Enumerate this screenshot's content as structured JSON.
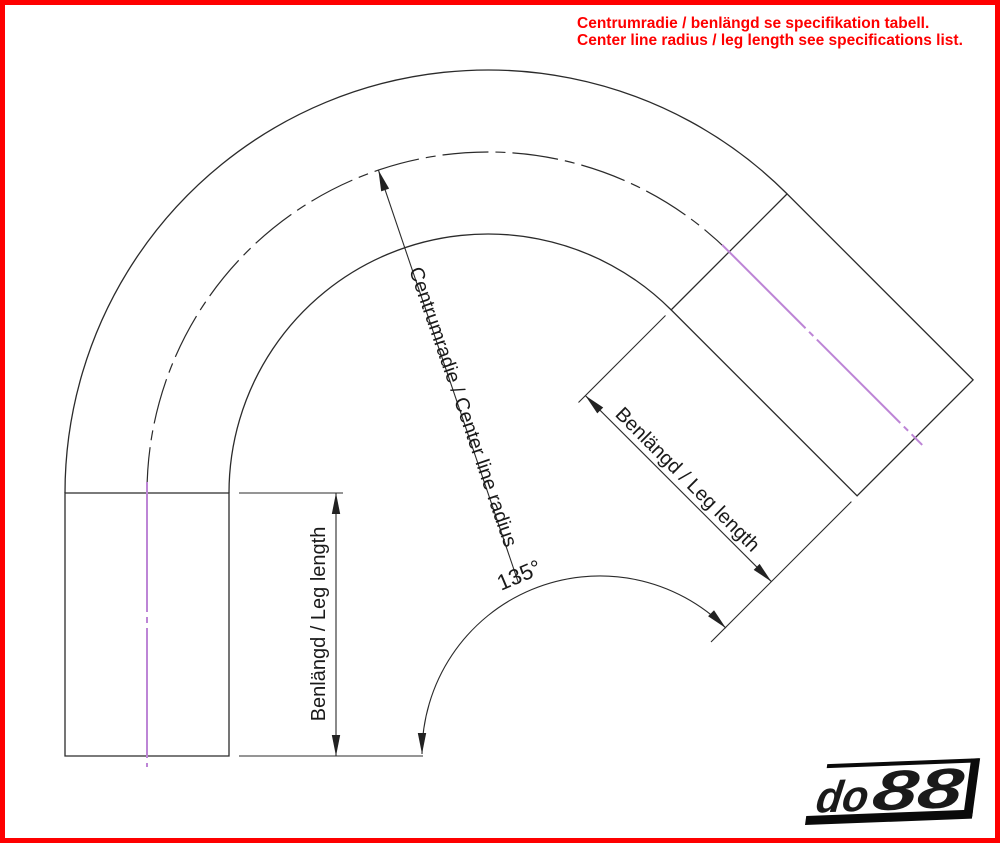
{
  "annotation": {
    "line1": "Centrumradie / benlängd se specifikation tabell.",
    "line2": "Center line radius / leg length see specifications list.",
    "color": "#fe0000"
  },
  "dimensions": {
    "left_leg_label": "Benlängd / Leg length",
    "right_leg_label": "Benlängd / Leg length",
    "radius_label": "Centrumradie / Center line radius",
    "angle_label": "135°",
    "bend_angle_deg": 135
  },
  "drawing": {
    "type": "technical-drawing",
    "subject": "135 degree bend with two straight legs",
    "line_color": "#2b2b2b",
    "centerline_color": "#bd85d6"
  },
  "logo": {
    "text": "do88",
    "part1": "do",
    "part2": "88",
    "color": "#0a0a0a"
  },
  "border_color": "#fe0000"
}
